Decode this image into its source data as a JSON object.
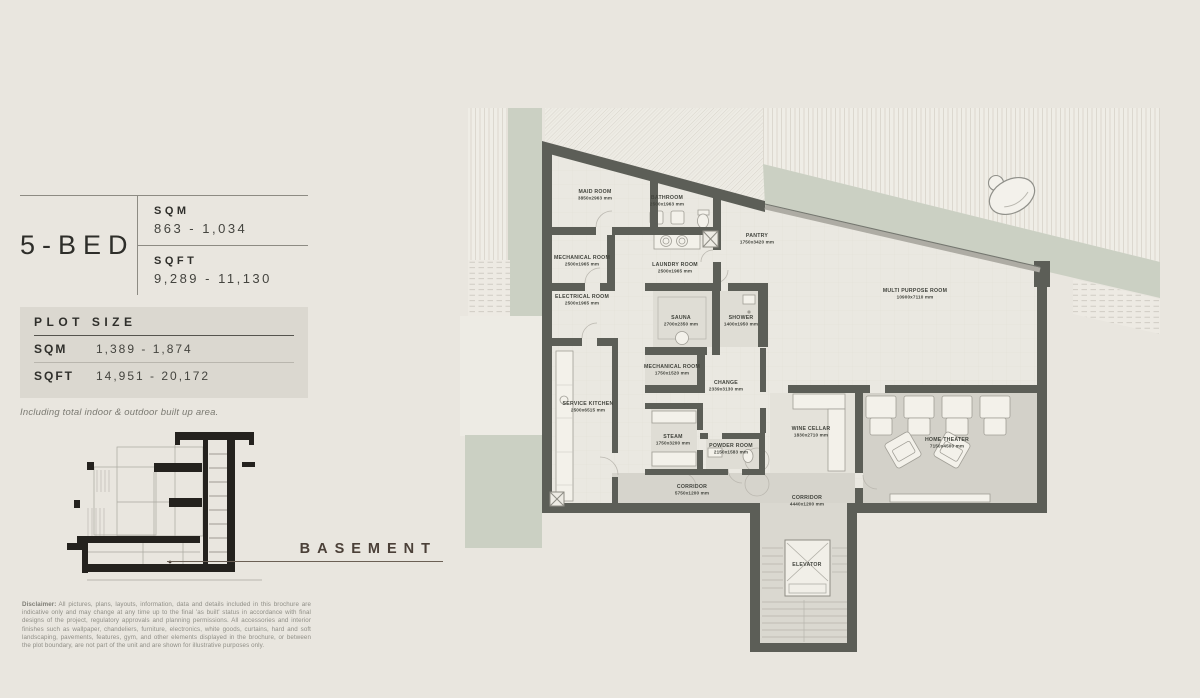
{
  "panel": {
    "title": "5-BED",
    "sqm_label": "SQM",
    "sqm_value": "863 - 1,034",
    "sqft_label": "SQFT",
    "sqft_value": "9,289 - 11,130",
    "plot": {
      "title": "PLOT SIZE",
      "rows": [
        {
          "label": "SQM",
          "value": "1,389 - 1,874"
        },
        {
          "label": "SQFT",
          "value": "14,951 - 20,172"
        }
      ]
    },
    "note": "Including total indoor & outdoor built up area.",
    "section_label": "BASEMENT",
    "disclaimer_label": "Disclaimer:",
    "disclaimer_text": "All pictures, plans, layouts, information, data and details included in this brochure are indicative only and may change at any time up to the final 'as built' status in accordance with final designs of the project, regulatory approvals and planning permissions. All accessories and interior finishes such as wallpaper, chandeliers, furniture, electronics, white goods, curtains, hard and soft landscaping, pavements, features, gym, and other elements displayed in the brochure, or between the plot boundary, are not part of the unit and are shown for illustrative purposes only."
  },
  "plan": {
    "floor_name": "BASEMENT",
    "rooms": [
      {
        "name": "MAID ROOM",
        "dims": "3850x2963 mm",
        "x": 135,
        "y": 93
      },
      {
        "name": "BATHROOM",
        "dims": "2500x1963 mm",
        "x": 207,
        "y": 99
      },
      {
        "name": "PANTRY",
        "dims": "1750x3420 mm",
        "x": 297,
        "y": 137
      },
      {
        "name": "MECHANICAL ROOM",
        "dims": "2500x1965 mm",
        "x": 122,
        "y": 159
      },
      {
        "name": "LAUNDRY ROOM",
        "dims": "2500x1965 mm",
        "x": 215,
        "y": 166
      },
      {
        "name": "ELECTRICAL ROOM",
        "dims": "2500x1965 mm",
        "x": 122,
        "y": 198
      },
      {
        "name": "SAUNA",
        "dims": "2700x2350 mm",
        "x": 221,
        "y": 219
      },
      {
        "name": "SHOWER",
        "dims": "1400x1950 mm",
        "x": 281,
        "y": 219
      },
      {
        "name": "MECHANICAL ROOM",
        "dims": "1750x1520 mm",
        "x": 212,
        "y": 268
      },
      {
        "name": "CHANGE",
        "dims": "2339x3130 mm",
        "x": 266,
        "y": 284
      },
      {
        "name": "STEAM",
        "dims": "1750x3200 mm",
        "x": 213,
        "y": 338
      },
      {
        "name": "POWDER ROOM",
        "dims": "2150x1583 mm",
        "x": 271,
        "y": 347
      },
      {
        "name": "SERVICE KITCHEN",
        "dims": "2500x6515 mm",
        "x": 128,
        "y": 305
      },
      {
        "name": "MULTI PURPOSE ROOM",
        "dims": "10900x7110 mm",
        "x": 455,
        "y": 192
      },
      {
        "name": "WINE CELLAR",
        "dims": "1830x2710 mm",
        "x": 351,
        "y": 330
      },
      {
        "name": "HOME THEATER",
        "dims": "7150x4500 mm",
        "x": 487,
        "y": 341
      },
      {
        "name": "CORRIDOR",
        "dims": "5750x1200 mm",
        "x": 232,
        "y": 388
      },
      {
        "name": "CORRIDOR",
        "dims": "4440x1200 mm",
        "x": 347,
        "y": 399
      },
      {
        "name": "ELEVATOR",
        "dims": "",
        "x": 347,
        "y": 466
      }
    ]
  },
  "colors": {
    "background": "#e9e6df",
    "wall": "#5c5e57",
    "sage_green": "#cbd0c3",
    "room_floor": "#eae8e1",
    "corridor_floor": "#d6d4cc",
    "plot_box": "#dbd8d0",
    "basement_text": "#4b4038"
  }
}
